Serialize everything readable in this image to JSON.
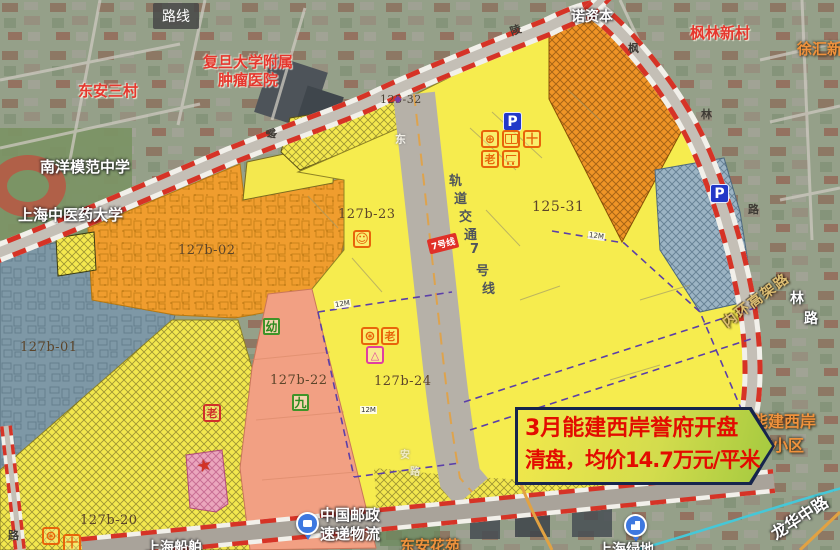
{
  "map": {
    "mini_label": "路线",
    "callout": {
      "line1": "3月能建西岸誉府开盘",
      "line2": "清盘，均价14.7万元/平米",
      "bg": "#e9e14a",
      "border": "#16254c",
      "text_color": "#e30b00"
    },
    "pois": {
      "dongan_sancun": "东安三村",
      "fudan_l1": "复旦大学附属",
      "fudan_l2": "肿瘤医院",
      "nuo_capital": "诺资本",
      "fenglin_xincun": "枫林新村",
      "xuhui_xincun": "徐汇新村",
      "nanyang_school": "南洋模范中学",
      "shzy_univ": "上海中医药大学",
      "nengjian_l1": "能建西岸",
      "nengjian_l2": "誉府小区",
      "post_l1": "中国邮政",
      "post_l2": "速递物流",
      "dongan_huayuan": "东安花苑",
      "sh_lvdi": "上海绿地",
      "sh_chuanbo": "上海船舶",
      "longhua_rd": "龙华中路",
      "neihuan_rd": "内环高架路",
      "fenglin_v1": "林",
      "fenglin_v2": "路"
    },
    "roads": {
      "lingling_c1": "零",
      "lingling_c2": "陵",
      "dongan_c1": "东",
      "dongan_c2": "安",
      "dongan_c3": "路",
      "fenglin_c1": "枫",
      "fenglin_c2": "林",
      "fenglin_c3": "路",
      "left_rd": "路"
    },
    "parcels": {
      "p127b01": "127b-01",
      "p127b02": "127b-02",
      "p127b20": "127b-20",
      "p127b22": "127b-22",
      "p127b23": "127b-23",
      "p127b24": "127b-24",
      "p12531": "125-31",
      "p12532": "125-32"
    },
    "rail": {
      "chars": [
        "轨",
        "道",
        "交",
        "通",
        "7",
        "号",
        "线"
      ],
      "badge": "7号线"
    },
    "badges": {
      "parking": "P",
      "kindergarten": "幼",
      "nine_year_school": "九",
      "elderly": "老",
      "clinic": "十",
      "substation": "△"
    },
    "icon_glyphs": {
      "community_smiley": "☺",
      "sports_ball": "⊕",
      "wheel": "⊛",
      "flag_star": "★",
      "purple_marker": "◆",
      "library": "open-book-css-shape",
      "market": "cart-css-shape"
    },
    "setback_label": "12M",
    "colors": {
      "parcel_yellow": "#f6ec4e",
      "parcel_orange": "#f09d2e",
      "parcel_bluegray": "#7e98a6",
      "parcel_salmon": "#f2a083",
      "parcel_pink": "#eba6bd",
      "boundary_red": "#d63326",
      "dashed_purple": "#5b3fa8",
      "metro_teal": "#45c8d8"
    }
  }
}
